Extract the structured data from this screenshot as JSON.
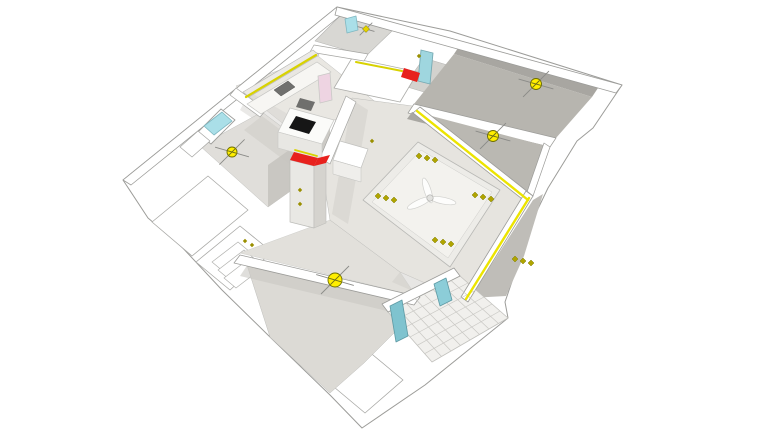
{
  "scene": {
    "background": "#ffffff",
    "default_stroke": "#a3a3a0",
    "legend": {
      "ceiling_light_color": "#ffee00",
      "spotlight_color": "#b0a400",
      "led_strip_color": "#d8d200",
      "accent_color": "#e8211d",
      "glass_color": "#aadfe8",
      "floor_light": "#e6e4df",
      "floor_dark": "#b7b5af"
    },
    "shapes_a": [
      {
        "n": "building-slab-outline",
        "p": "337,7 450,31 622,85 593,128 577,141 548,188 535,215 520,258 505,302 508,318 425,385 362,428 330,395 270,337 222,290 180,245 148,218 123,180",
        "f": "#ffffff",
        "s": "#9c9c99",
        "w": 1
      },
      {
        "n": "exterior-ledge-left-1",
        "p": "152,222 208,176 248,210 192,256",
        "f": "#ffffff",
        "s": "#a8a8a5",
        "w": 0.8
      },
      {
        "n": "exterior-ledge-left-2",
        "p": "196,262 240,226 272,252 230,290",
        "f": "#ffffff",
        "s": "#a8a8a5",
        "w": 0.8
      },
      {
        "n": "exterior-slab-diamond",
        "p": "367,350 403,380 365,413 328,382",
        "f": "#ffffff",
        "s": "#a8a8a5",
        "w": 0.8
      },
      {
        "n": "entry-step-1",
        "p": "212,262 238,242 250,252 224,272",
        "f": "#ffffff",
        "s": "#b0b0ad",
        "w": 0.7
      },
      {
        "n": "entry-step-2",
        "p": "218,270 244,250 256,260 230,280",
        "f": "#ffffff",
        "s": "#b0b0ad",
        "w": 0.7
      },
      {
        "n": "entry-step-3",
        "p": "224,278 250,258 262,268 236,288",
        "f": "#ffffff",
        "s": "#b0b0ad",
        "w": 0.7
      },
      {
        "n": "bathroom-top-floor",
        "p": "340,16 392,31 366,56 315,41",
        "f": "#d8d7d3",
        "s": "#b5b5b2",
        "w": 0.6
      },
      {
        "n": "bathroom-2-floor",
        "p": "424,58 464,70 444,98 404,86",
        "f": "#d3d2ce",
        "s": "#b5b5b2",
        "w": 0.6
      },
      {
        "n": "kitchen-floor",
        "p": "236,86 318,56 378,104 296,134",
        "f": "#e9e7e2",
        "s": "#bfbfbc",
        "w": 0.5
      },
      {
        "n": "kitchen-floor-shadow",
        "p": "250,92 298,120 282,138 240,110",
        "f": "#d6d4cf",
        "o": 0.5
      },
      {
        "n": "bedroom-left-floor",
        "p": "200,146 262,112 330,163 268,207",
        "f": "#e0deda",
        "s": "#bfbfbc",
        "w": 0.5
      },
      {
        "n": "bedroom-left-shadow",
        "p": "262,116 330,167 312,181 244,130",
        "f": "#cfcdc8",
        "o": 0.6
      },
      {
        "n": "bedroom-left-wallface",
        "p": "268,207 330,163 330,121 268,165",
        "f": "#c6c4bf",
        "o": 0.9
      },
      {
        "n": "hallway-floor",
        "p": "330,220 400,272 416,296 240,253",
        "f": "#e2e0db",
        "s": "#c6c6c3",
        "w": 0.4
      },
      {
        "n": "livingroom-floor",
        "p": "352,98 420,107 533,196 468,302 400,272 330,220 322,170 338,122",
        "f": "#e6e4df",
        "s": "#bdbdba",
        "w": 0.5
      },
      {
        "n": "livingroom-shadow-west",
        "p": "352,100 368,110 348,224 332,214",
        "f": "#d2d0cb",
        "o": 0.55
      },
      {
        "n": "livingroom-shadow-south",
        "p": "400,272 462,298 452,308 392,282",
        "f": "#d0cec9",
        "o": 0.5
      },
      {
        "n": "tray-ceiling-outer",
        "p": "418,142 500,190 450,267 363,200",
        "f": "#edece8",
        "s": "#b8b8b5",
        "w": 0.8
      },
      {
        "n": "tray-ceiling-inner",
        "p": "421,150 492,192 448,258 372,202",
        "f": "#f3f2ee",
        "s": "#cdcdca",
        "w": 0.5
      },
      {
        "n": "bedroom-bottom-floor",
        "p": "246,262 420,300 424,303 364,363 330,393 270,337",
        "f": "#dcdad5",
        "s": "#bdbdba",
        "w": 0.5
      },
      {
        "n": "bedroom-bottom-shadow",
        "p": "248,264 418,302 408,316 240,276",
        "f": "#cac8c3",
        "o": 0.6
      },
      {
        "n": "bedroom-right-1-wallband",
        "p": "462,42 600,85 592,97 454,54",
        "f": "#a8a6a1"
      },
      {
        "n": "bedroom-right-1-floor",
        "p": "454,54 592,97 556,138 414,104",
        "f": "#b7b5af"
      },
      {
        "n": "wall-bedrooms-divider",
        "p": "414,104 556,138 550,147 408,113",
        "f": "#ffffff",
        "s": "#9c9c99",
        "w": 0.7
      },
      {
        "n": "bedroom-right-2-wallband",
        "p": "412,112 550,147 545,154 407,119",
        "f": "#a9a7a2"
      },
      {
        "n": "bedroom-right-2-floor",
        "p": "424,114 550,147 533,196",
        "f": "#bab8b2"
      },
      {
        "n": "wall-bedroom2-east",
        "p": "550,147 533,196 527,192 544,143",
        "f": "#ffffff",
        "s": "#9c9c99",
        "w": 0.7
      },
      {
        "n": "room-right-3-floor",
        "p": "533,200 543,194 524,256 506,296 470,298",
        "f": "#bfbdb8"
      },
      {
        "n": "balcony-floor",
        "p": "388,312 460,276 508,318 432,362",
        "f": "#f1f0ed",
        "s": "#c2c1bd",
        "w": 0.8
      },
      {
        "n": "wall-top-northwest-edge",
        "p": "123,180 337,7 345,12 131,185",
        "f": "#ffffff",
        "s": "#9c9c99",
        "w": 0.8
      },
      {
        "n": "wall-top-northeast-edge",
        "p": "337,7 622,85 616,93 335,15",
        "f": "#ffffff",
        "s": "#9c9c99",
        "w": 0.8
      },
      {
        "n": "corridor-ceiling-slab",
        "p": "352,58 418,72 400,102 334,88",
        "f": "#ffffff",
        "s": "#adadaa",
        "w": 0.8
      },
      {
        "n": "wall-bathroom-top-south",
        "p": "314,45 368,54 364,61 310,52",
        "f": "#ffffff",
        "s": "#a5a5a2",
        "w": 0.7
      },
      {
        "n": "wall-kitchen-east",
        "p": "346,96 356,102 330,164 320,158",
        "f": "#ffffff",
        "s": "#a5a5a2",
        "w": 0.7
      },
      {
        "n": "wall-bedroom-left-north",
        "p": "236,88 266,110 260,117 230,95",
        "f": "#ffffff",
        "s": "#a5a5a2",
        "w": 0.7
      },
      {
        "n": "wall-livingroom-northeast",
        "p": "420,107 533,196 526,202 413,113",
        "f": "#ffffff",
        "s": "#9c9c99",
        "w": 0.8
      },
      {
        "n": "wall-livingroom-southeast",
        "p": "533,196 468,302 461,297 526,191",
        "f": "#ffffff",
        "s": "#9c9c99",
        "w": 0.8
      },
      {
        "n": "wall-bedroom-bottom-north",
        "p": "240,255 420,297 414,305 234,263",
        "f": "#ffffff",
        "s": "#9c9c99",
        "w": 0.8
      },
      {
        "n": "wall-balcony-northwest",
        "p": "382,304 454,268 460,276 388,312",
        "f": "#ffffff",
        "s": "#9c9c99",
        "w": 0.8
      }
    ],
    "balcony_grid": {
      "pts": "388,312 460,276 508,318 432,362",
      "cols": 8,
      "rows": 6,
      "stroke": "#c9c8c4",
      "w": 0.7
    },
    "shapes_b": [
      {
        "n": "balcony-glass-pane-1",
        "p": "390,306 402,300 408,336 396,342",
        "f": "#7fc3cf",
        "s": "#5e9aa4",
        "w": 0.8
      },
      {
        "n": "balcony-glass-pane-2",
        "p": "434,284 446,278 452,300 440,306",
        "f": "#8ccdd8",
        "s": "#5e9aa4",
        "w": 0.8
      },
      {
        "n": "kitchen-upper-cabinets",
        "p": "243,92 313,50 319,55 249,97",
        "f": "#eceae6",
        "s": "#b5b5b2",
        "w": 0.6
      },
      {
        "n": "kitchen-counter",
        "p": "247,104 317,62 331,72 261,114",
        "f": "#f7f6f3",
        "s": "#c6c6c3",
        "w": 0.7
      },
      {
        "n": "kitchen-sink",
        "p": "274,90 288,81 295,87 281,96",
        "f": "#70706e",
        "s": "#555553",
        "w": 0.5
      },
      {
        "n": "kitchen-island-top",
        "p": "290,108 334,120 322,144 278,132",
        "f": "#fbfbf9",
        "s": "#c9c9c6",
        "w": 0.8
      },
      {
        "n": "kitchen-island-front",
        "p": "278,132 322,144 322,160 278,148",
        "f": "#e8e7e3",
        "s": "#c9c9c6",
        "w": 0.6
      },
      {
        "n": "island-cooktop",
        "p": "296,116 316,122 309,134 289,128",
        "f": "#161616"
      },
      {
        "n": "range-hood",
        "p": "300,98 315,102 311,111 296,107",
        "f": "#6f6f6d"
      },
      {
        "n": "dining-cabinet-top",
        "p": "340,141 368,149 361,168 333,160",
        "f": "#ffffff",
        "s": "#c2c2bf",
        "w": 0.7
      },
      {
        "n": "dining-cabinet-front",
        "p": "333,160 361,168 361,182 333,174",
        "f": "#efeeeb",
        "s": "#c2c2bf",
        "w": 0.5
      },
      {
        "n": "entry-closet-front",
        "p": "290,160 314,166 314,228 290,222",
        "f": "#e9e8e4",
        "s": "#bdbdb9",
        "w": 0.7
      },
      {
        "n": "entry-closet-side",
        "p": "314,166 326,161 326,223 314,228",
        "f": "#d5d3ce",
        "s": "#bdbdb9",
        "w": 0.6
      },
      {
        "n": "closet-red-beam-top",
        "p": "294,152 318,158 314,166 290,160",
        "f": "#e8211d"
      },
      {
        "n": "closet-red-beam-arm",
        "p": "318,158 330,155 326,163 314,166",
        "f": "#e8211d"
      },
      {
        "n": "bedroom-left-window-frame",
        "p": "197,133 221,109 235,120 211,144",
        "f": "#ffffff",
        "s": "#9e9e9b",
        "w": 0.9
      },
      {
        "n": "bedroom-left-window-glass",
        "p": "204,126 222,112 232,121 214,135",
        "f": "#aadfe8",
        "s": "#7fb7c1",
        "w": 0.8
      },
      {
        "n": "bedroom-left-window-sill",
        "p": "180,147 198,131 210,141 192,157",
        "f": "#ffffff",
        "s": "#a5a5a2",
        "w": 0.7
      },
      {
        "n": "top-tip-window",
        "p": "345,19 356,16 358,30 347,33",
        "f": "#aadfe8",
        "s": "#7fb7c1",
        "w": 0.8
      },
      {
        "n": "bathroom-2-glass-door",
        "p": "421,50 433,53 430,84 418,81",
        "f": "#9fd6df",
        "s": "#76a9b2",
        "w": 0.9
      },
      {
        "n": "bathroom-pink-door",
        "p": "318,76 330,73 332,100 320,103",
        "f": "#eed4e2",
        "s": "#c9c9c6",
        "w": 0.8
      },
      {
        "n": "corridor-red-beam",
        "p": "404,68 420,73 417,82 401,77",
        "f": "#e8211d"
      }
    ],
    "strips": [
      {
        "n": "led-strip-kitchen",
        "p": [
          246,
          97,
          316,
          55
        ],
        "s": "#d8d200",
        "w": 2.2
      },
      {
        "n": "led-strip-corridor",
        "p": [
          356,
          62,
          402,
          71
        ],
        "s": "#d8d200",
        "w": 2
      },
      {
        "n": "led-strip-livingroom-ne",
        "p": [
          417,
          111,
          528,
          200
        ],
        "s": "#ece400",
        "w": 2.4
      },
      {
        "n": "led-strip-livingroom-se",
        "p": [
          529,
          198,
          466,
          299
        ],
        "s": "#ece400",
        "w": 2.4
      },
      {
        "n": "led-strip-closet",
        "p": [
          295,
          150,
          317,
          156
        ],
        "s": "#d8d200",
        "w": 1.8
      }
    ],
    "spotlight_triplets": [
      {
        "x": 427,
        "y": 158
      },
      {
        "x": 483,
        "y": 197
      },
      {
        "x": 386,
        "y": 198
      },
      {
        "x": 443,
        "y": 242
      },
      {
        "x": 523,
        "y": 261
      }
    ],
    "small_dots": [
      {
        "x": 300,
        "y": 190
      },
      {
        "x": 300,
        "y": 204
      },
      {
        "x": 372,
        "y": 141
      },
      {
        "x": 419,
        "y": 56
      },
      {
        "x": 245,
        "y": 241
      },
      {
        "x": 252,
        "y": 245
      }
    ],
    "ceiling_lights": [
      {
        "n": "ceiling-light-bedroom-left",
        "x": 232,
        "y": 152,
        "r": 5
      },
      {
        "n": "ceiling-light-bedroom-bottom",
        "x": 335,
        "y": 280,
        "r": 7
      },
      {
        "n": "ceiling-light-bedroom-right-1",
        "x": 536,
        "y": 84,
        "r": 5.5
      },
      {
        "n": "ceiling-light-bedroom-right-2",
        "x": 493,
        "y": 136,
        "r": 5.5
      }
    ],
    "mini_light": {
      "n": "ceiling-light-bathroom-top",
      "x": 366,
      "y": 29,
      "r": 3.5
    },
    "fan": {
      "cx": 430,
      "cy": 198,
      "blade_len": 14,
      "blade_r": 13,
      "angles": [
        20,
        140,
        260
      ]
    }
  }
}
